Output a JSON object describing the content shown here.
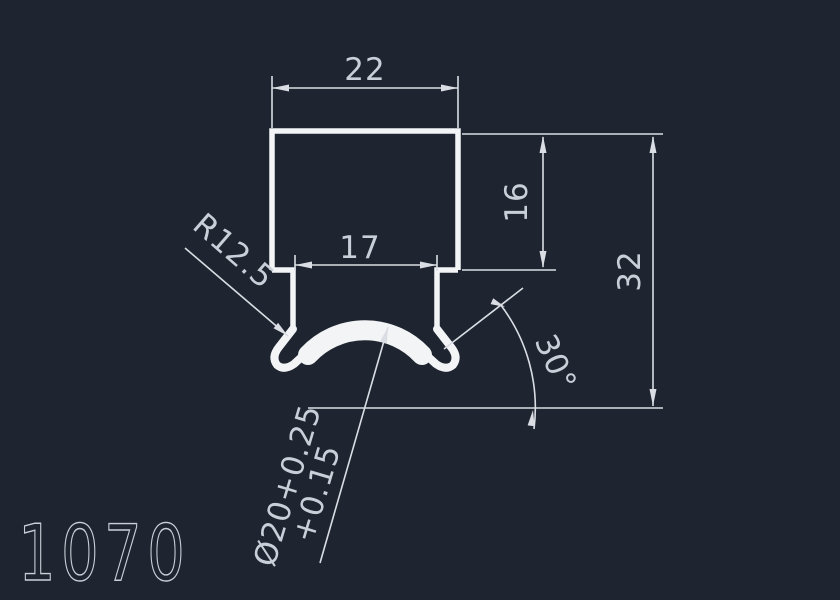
{
  "colors": {
    "background": "#1f2530",
    "profile": "#f2f4f6",
    "dimension": "#dadee4",
    "text": "#c9cfd8"
  },
  "drawing": {
    "part_number": "1070",
    "dimensions": {
      "top_width": "22",
      "slot_width": "17",
      "body_height": "16",
      "total_height": "32",
      "fillet_radius": "R12.5",
      "bore_diameter": "Ø20+0.25",
      "bore_tolerance": "+0.15",
      "flare_angle": "30°"
    }
  }
}
